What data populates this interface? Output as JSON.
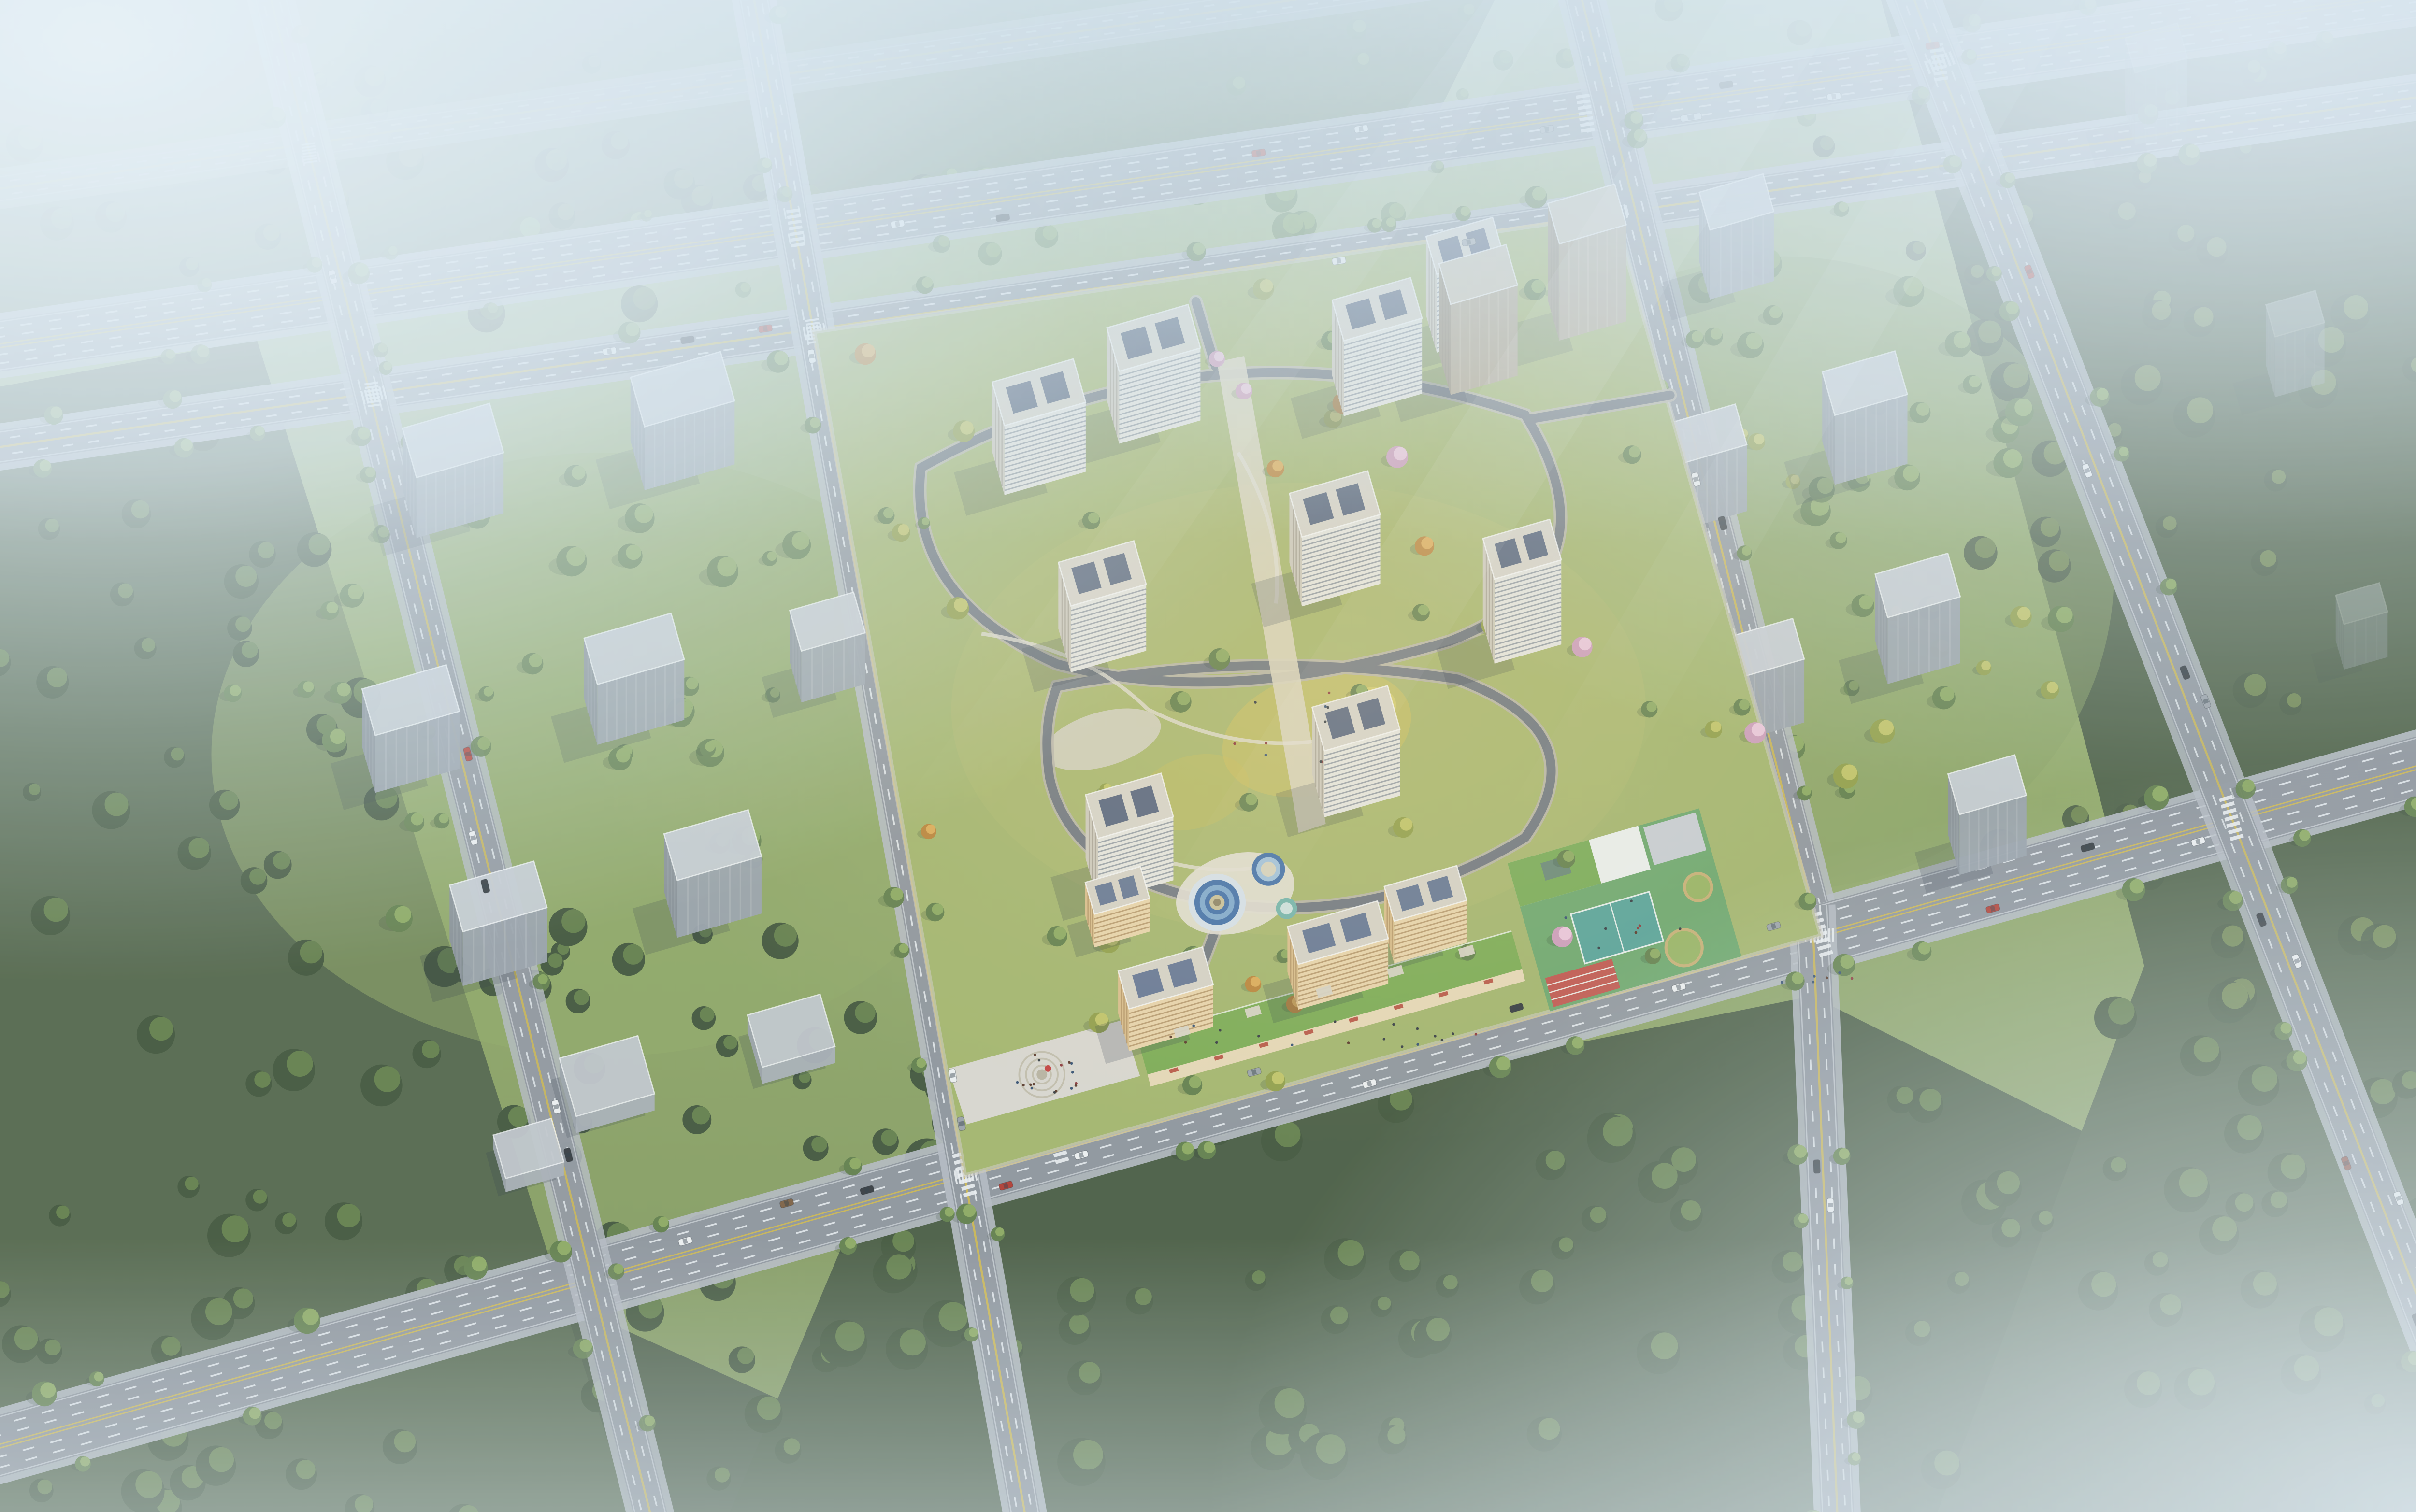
{
  "scene": {
    "title": "Aerial bird's-eye architectural rendering of a residential development masterplan",
    "media_type": "3D architectural visualization render",
    "view": "high-angle aerial view over a diagonal street grid",
    "lighting": "hazy daylight, warm low sun over the central compound, dense white-blue fog in the top-left, top edge and bottom-right corner",
    "visible_text": "none"
  },
  "compound": {
    "label": "central residential compound",
    "white_towers": 9,
    "tan_massing_towers": 2,
    "warm_sunlit_midrises": 4,
    "amenities": [
      "landscaped courtyard with golden autumn garden",
      "circular blue play pools",
      "kindergarten with green roof, teal ball court and red running track",
      "street-front retail podium with green roofs and red awnings",
      "entrance plaza with circular paving and red sculpture"
    ]
  },
  "context": {
    "label": "surrounding city blocks",
    "gray_massing_buildings": 19,
    "low_podium_slabs": 3,
    "forest": "dense dark tree cover south and east, hazy forest north",
    "roads": "two east-west arterials, one front boulevard, four north-south streets",
    "traffic": "cars and one bus"
  },
  "palette": {
    "haze": "#e3eef6",
    "sky_tint": "#bcd8e8",
    "ground_top": "#a9bd86",
    "ground_mid": "#93aa63",
    "ground_low": "#7d9355",
    "forest_dark": "#3c4f31",
    "forest_lit": "#5f7a41",
    "park_tree": "#5d7a41",
    "park_tree_lit": "#8aa758",
    "autumn_tree": "#bb7f2e",
    "autumn_lit": "#dfa94e",
    "blossom": "#cf9ab8",
    "road_asphalt": "#8d9298",
    "road_casing": "#b6bac0",
    "lane_yellow": "#d7ba3e",
    "lane_white": "#eef1f2",
    "tower_facade": "#e9e7df",
    "tower_stripe": "#7f8892",
    "tower_side": "#cfc9ba",
    "roof_slab": "#d9d4c7",
    "roof_panel": "#42526e",
    "warm_facade": "#ecd4a6",
    "warm_stripe": "#ab8755",
    "warm_side": "#dcbd85",
    "ctx_facade": "#99a0a7",
    "ctx_stripe": "#adb3b9",
    "ctx_side": "#878e95",
    "ctx_roof": "#c9cdd2",
    "tan_facade": "#b2a48b",
    "tan_side": "#9a8d77",
    "green_roof": "#79a94a",
    "shopfront": "#ead9b2",
    "awning_red": "#b5412f",
    "plaza_paving": "#dcd8cd",
    "pool_blue": "#3c6ba5",
    "pool_light": "#7ba6cd",
    "court_teal": "#53a093",
    "track_red": "#c14f44",
    "turf": "#69a565",
    "gold_lawn": "#d9c252",
    "car_white": "#f2f3f2",
    "car_dark": "#2f3336",
    "car_red": "#b23427",
    "car_silver": "#9aa0a5",
    "shadow": "rgba(34,46,60,0.20)"
  }
}
